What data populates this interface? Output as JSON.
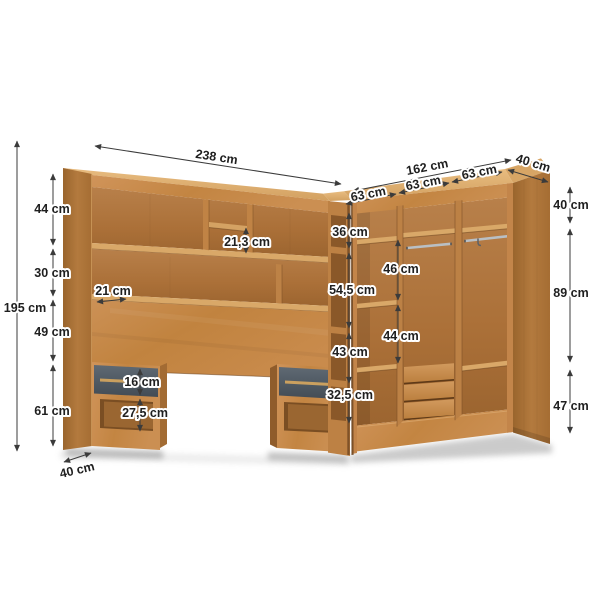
{
  "diagram": {
    "kind": "corner wardrobe with headboard - dimension drawing",
    "unit": "cm"
  },
  "dimensions": {
    "headboard_width": "238 cm",
    "wardrobe_width": "162 cm",
    "wardrobe_depth": "40 cm",
    "door_section_1": "63 cm",
    "door_section_2": "63 cm",
    "door_section_3": "63 cm",
    "total_height": "195 cm",
    "top_section": "44 cm",
    "shelf_section": "30 cm",
    "panel_section": "49 cm",
    "leg_section": "61 cm",
    "shelf_depth": "21 cm",
    "cubby_height": "21,3 cm",
    "drawer_height": "16 cm",
    "niche_height": "27,5 cm",
    "nightstand_depth": "40 cm",
    "corner_top": "36 cm",
    "corner_upper": "54,5 cm",
    "corner_lower": "43 cm",
    "corner_bottom": "32,5 cm",
    "hanging_upper": "46 cm",
    "hanging_lower": "44 cm",
    "right_top": "40 cm",
    "right_middle": "89 cm",
    "right_bottom": "47 cm"
  },
  "colors": {
    "wood_front": "#c98d51",
    "wood_side": "#a9713a",
    "wood_top": "#dfae70",
    "wood_interior": "#ae7641",
    "drawer_gray": "#57616a",
    "rail_metal": "#b9bfc4",
    "dimension_line": "#3b3b3b",
    "background": "#ffffff"
  }
}
